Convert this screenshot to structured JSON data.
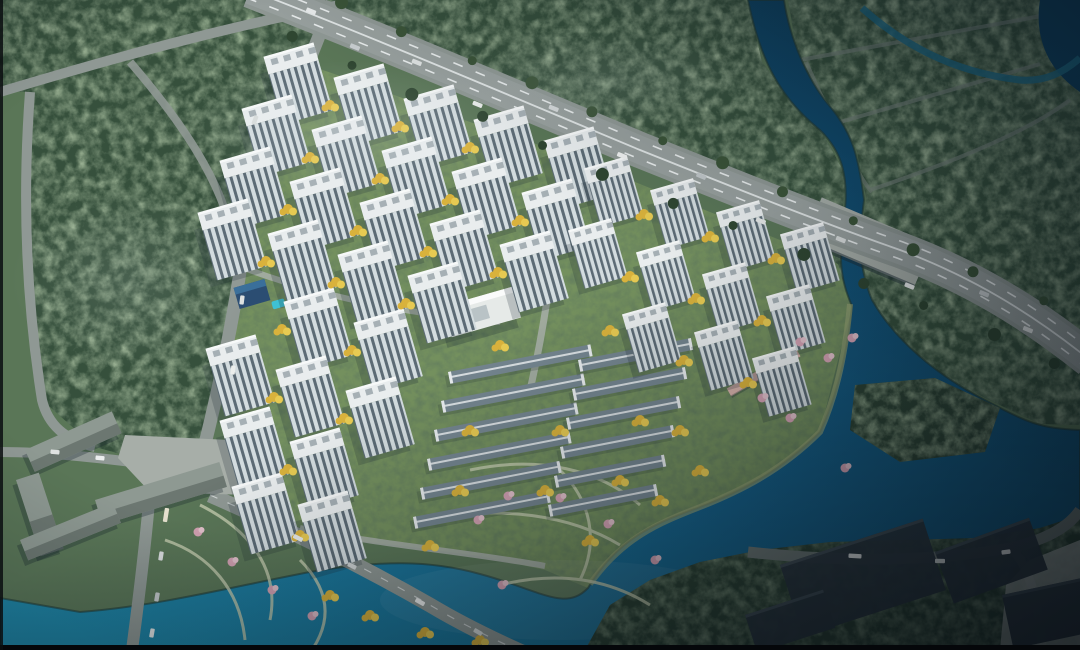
{
  "meta": {
    "description": "Aerial bird's-eye architectural rendering of a riverside residential master-plan: white high-rise apartment slabs and townhouse rows amid green landscaping and yellow trees, bounded by a diagonal arterial highway, dark forest parkland to the north-west and a winding teal river/lake to the east and south",
    "render_type": "real-estate-masterplan-render"
  },
  "palette": {
    "land": "#5e7a58",
    "lawn": "#74905e",
    "forest": "#36503c",
    "forest_edge": "#2c4233",
    "water_bright": "#1f87a8",
    "water_mid": "#16618a",
    "water_dark": "#0d3f5e",
    "water_deep": "#0a2f47",
    "shore": "#243c33",
    "sand": "#98a474",
    "road": "#8f9894",
    "road_light": "#a8afa9",
    "road_dark": "#6f7a77",
    "lane_white": "#e8ecec",
    "plaza": "#a7aea8",
    "path_light": "#c3cbae",
    "building_roof": "#e9edee",
    "roof_top": "#f7f9f9",
    "roof_unit": "#a6b0b5",
    "facade_light": "#d3dcdf",
    "facade_dark": "#5c6b75",
    "shadow": "#1d2b33",
    "townhouse_roof": "#74858f",
    "townhouse_ridge": "#d9dfe2",
    "gray_building": "#8e9992",
    "gray_building_side": "#66716b",
    "warehouse": "#2c3840",
    "tree_yellow": "#d9b23c",
    "tree_yellow2": "#e7ca52",
    "tree_pink": "#d5a3b4",
    "tree_pink2": "#e4c2cc",
    "median_green": "#2f4631",
    "median_green2": "#3b5438",
    "pier_pink": "#d8b3ab",
    "pool_cyan": "#3ec1d3",
    "clubhouse_blue": "#2b4d72",
    "clubhouse_blue2": "#3a6f9a",
    "school_roof": "#e6eae8",
    "fog": "#dfe8ec",
    "letterbox": "#05070a"
  },
  "scene": {
    "highway": {
      "path": "M250,-10 C380,40 520,100 640,150 C740,190 820,222 900,250 C970,276 1030,312 1090,360",
      "width": 36,
      "angle_deg": 22,
      "x1": 250,
      "y1": -6,
      "x2": 1080,
      "y2": 356,
      "tree_count": 26
    },
    "towers": {
      "angle": -16,
      "w": 52,
      "facade_h": 52,
      "roof_h": 17,
      "items": [
        [
          296,
          76
        ],
        [
          366,
          97
        ],
        [
          436,
          118
        ],
        [
          506,
          139
        ],
        [
          576,
          160
        ],
        [
          274,
          128
        ],
        [
          344,
          149
        ],
        [
          414,
          170
        ],
        [
          484,
          191
        ],
        [
          554,
          212
        ],
        [
          252,
          180
        ],
        [
          322,
          201
        ],
        [
          392,
          222
        ],
        [
          462,
          243
        ],
        [
          532,
          264
        ],
        [
          230,
          232
        ],
        [
          300,
          253
        ],
        [
          370,
          274
        ],
        [
          440,
          295
        ],
        [
          316,
          321
        ],
        [
          386,
          342
        ],
        [
          238,
          368
        ],
        [
          308,
          389
        ],
        [
          378,
          410
        ],
        [
          252,
          440
        ],
        [
          322,
          461
        ],
        [
          264,
          506
        ],
        [
          330,
          524
        ],
        [
          612,
          185,
          0.86
        ],
        [
          678,
          207,
          0.86
        ],
        [
          744,
          229,
          0.86
        ],
        [
          808,
          251,
          0.86
        ],
        [
          596,
          247,
          0.86
        ],
        [
          664,
          269,
          0.86
        ],
        [
          730,
          291,
          0.86
        ],
        [
          794,
          313,
          0.86
        ],
        [
          650,
          331,
          0.86
        ],
        [
          722,
          349,
          0.86
        ],
        [
          780,
          375,
          0.86
        ]
      ]
    },
    "townhouses": {
      "angle": -11,
      "h": 12,
      "items": [
        [
          448,
          372,
          145
        ],
        [
          441,
          401,
          145
        ],
        [
          434,
          430,
          145
        ],
        [
          427,
          459,
          145
        ],
        [
          420,
          488,
          142
        ],
        [
          413,
          517,
          138
        ],
        [
          578,
          360,
          115
        ],
        [
          572,
          389,
          115
        ],
        [
          566,
          418,
          115
        ],
        [
          560,
          447,
          115
        ],
        [
          554,
          476,
          112
        ],
        [
          548,
          505,
          110
        ]
      ]
    },
    "gray_buildings": [
      [
        25,
        450,
        95,
        24,
        -24
      ],
      [
        16,
        480,
        24,
        80,
        -18
      ],
      [
        95,
        500,
        130,
        26,
        -17
      ],
      [
        20,
        540,
        100,
        22,
        -22
      ]
    ],
    "warehouses": [
      [
        780,
        565,
        150,
        75,
        -18
      ],
      [
        935,
        552,
        100,
        55,
        -20
      ],
      [
        1002,
        595,
        80,
        55,
        -12
      ],
      [
        745,
        615,
        82,
        40,
        -18
      ]
    ],
    "yellow_trees": [
      [
        330,
        105
      ],
      [
        400,
        126
      ],
      [
        470,
        147
      ],
      [
        310,
        157
      ],
      [
        380,
        178
      ],
      [
        450,
        199
      ],
      [
        520,
        220
      ],
      [
        288,
        209
      ],
      [
        358,
        230
      ],
      [
        428,
        251
      ],
      [
        498,
        272
      ],
      [
        266,
        261
      ],
      [
        336,
        282
      ],
      [
        406,
        303
      ],
      [
        282,
        329
      ],
      [
        352,
        350
      ],
      [
        274,
        397
      ],
      [
        344,
        418
      ],
      [
        288,
        469
      ],
      [
        300,
        535
      ],
      [
        644,
        214
      ],
      [
        710,
        236
      ],
      [
        776,
        258
      ],
      [
        630,
        276
      ],
      [
        696,
        298
      ],
      [
        762,
        320
      ],
      [
        684,
        360
      ],
      [
        748,
        382
      ],
      [
        500,
        345
      ],
      [
        470,
        430
      ],
      [
        460,
        490
      ],
      [
        430,
        545
      ],
      [
        560,
        430
      ],
      [
        545,
        490
      ],
      [
        610,
        330
      ],
      [
        640,
        420
      ],
      [
        620,
        480
      ],
      [
        590,
        540
      ],
      [
        330,
        595
      ],
      [
        370,
        615
      ],
      [
        425,
        632
      ],
      [
        480,
        640
      ],
      [
        680,
        430
      ],
      [
        700,
        470
      ],
      [
        660,
        500
      ]
    ],
    "pink_trees": [
      [
        800,
        342
      ],
      [
        828,
        358
      ],
      [
        762,
        398
      ],
      [
        790,
        418
      ],
      [
        852,
        338
      ],
      [
        845,
        468
      ],
      [
        560,
        498
      ],
      [
        608,
        524
      ],
      [
        502,
        585
      ],
      [
        655,
        560
      ],
      [
        232,
        562
      ],
      [
        272,
        590
      ],
      [
        312,
        616
      ],
      [
        198,
        532
      ],
      [
        508,
        496
      ],
      [
        478,
        520
      ]
    ],
    "vehicles_highway": [
      [
        0.07,
        -8,
        "#e9ecec"
      ],
      [
        0.13,
        8,
        "#c9ced0"
      ],
      [
        0.2,
        -2,
        "#dfe3e2"
      ],
      [
        0.28,
        13,
        "#eceeed"
      ],
      [
        0.36,
        -13,
        "#d6dadb"
      ],
      [
        0.45,
        4,
        "#f0f2f1"
      ],
      [
        0.54,
        -8,
        "#c2c8ca"
      ],
      [
        0.62,
        10,
        "#e6e9e8"
      ],
      [
        0.71,
        -4,
        "#dbdfde"
      ],
      [
        0.8,
        12,
        "#eef0ef"
      ],
      [
        0.88,
        -10,
        "#cfd4d5"
      ],
      [
        0.94,
        6,
        "#e4e7e6"
      ]
    ],
    "vehicles": [
      [
        166,
        515,
        -81,
        "#e7e2cf",
        14
      ],
      [
        161,
        556,
        -81,
        "#dde0e1",
        9
      ],
      [
        157,
        597,
        -80,
        "#c8cdcf",
        9
      ],
      [
        152,
        633,
        -80,
        "#e9eceb",
        9
      ],
      [
        55,
        452,
        6,
        "#dfe2e1",
        9
      ],
      [
        100,
        458,
        6,
        "#eceeee",
        9
      ],
      [
        242,
        300,
        -83,
        "#dee2e1",
        9
      ],
      [
        233,
        370,
        -83,
        "#ebeeec",
        9
      ],
      [
        255,
        120,
        -70,
        "#d8dcdb",
        9
      ],
      [
        298,
        538,
        27,
        "#e8ebe9",
        10
      ],
      [
        352,
        566,
        27,
        "#d2d6d6",
        9
      ],
      [
        420,
        602,
        29,
        "#eff1f0",
        10
      ],
      [
        478,
        632,
        30,
        "#dadedd",
        9
      ],
      [
        855,
        556,
        3,
        "#e9eceb",
        13
      ],
      [
        940,
        561,
        1,
        "#dfe3e2",
        10
      ],
      [
        1006,
        552,
        -8,
        "#eceeed",
        9
      ]
    ]
  }
}
